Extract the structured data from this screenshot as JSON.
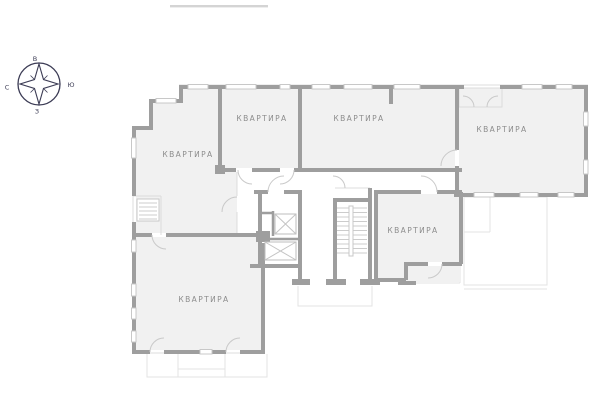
{
  "compass": {
    "top": "В",
    "right": "Ю",
    "left": "С",
    "bottom": "З"
  },
  "floor_plan": {
    "apartments": [
      {
        "label": "КВАРТИРА"
      },
      {
        "label": "КВАРТИРА"
      },
      {
        "label": "КВАРТИРА"
      },
      {
        "label": "КВАРТИРА"
      },
      {
        "label": "КВАРТИРА"
      },
      {
        "label": "КВАРТИРА"
      }
    ],
    "icons": {
      "compass": "compass-rose",
      "elevator": "crossed-box-shaft",
      "staircase": "step-lines"
    }
  },
  "colors": {
    "wall": "#9e9e9e",
    "room_fill": "#f1f1f1",
    "thin_line": "#dcdcdc",
    "label_text": "#8d8d8d",
    "compass": "#3c3c55",
    "background": "#ffffff"
  }
}
